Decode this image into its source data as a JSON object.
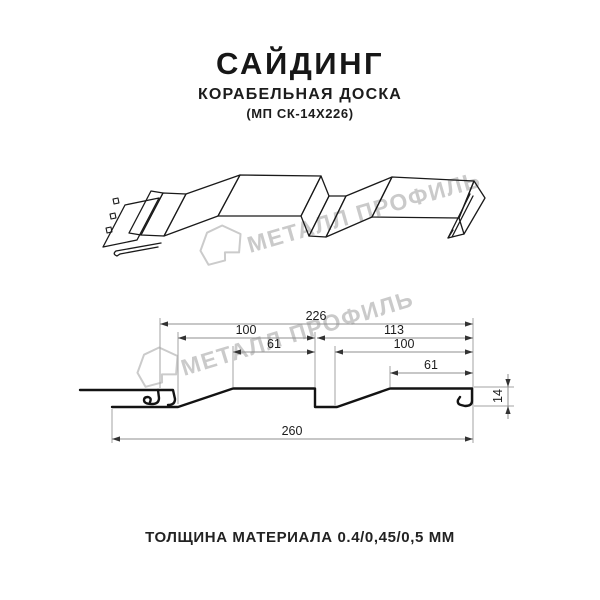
{
  "header": {
    "title": "САЙДИНГ",
    "subtitle": "КОРАБЕЛЬНАЯ ДОСКА",
    "model": "(МП СК-14Х226)"
  },
  "watermark": {
    "brand": "МЕТАЛЛ ПРОФИЛЬ",
    "logo_icon": "metal-profil-logo-icon",
    "color": "#c8c8c8"
  },
  "drawing": {
    "description": "3d-siding-panel-line-art",
    "ink_color": "#1a1a1a"
  },
  "diagram": {
    "units": "mm",
    "line_color": "#a3a3a3",
    "dim_overall_top": "226",
    "dim_left_pitch": "100",
    "dim_right_pitch": "113",
    "dim_left_flat": "61",
    "dim_right_inner": "100",
    "dim_right_flat": "61",
    "dim_overall_bottom": "260",
    "dim_height": "14"
  },
  "footer": {
    "thickness_note": "ТОЛЩИНА МАТЕРИАЛА 0.4/0,45/0,5 ММ"
  }
}
